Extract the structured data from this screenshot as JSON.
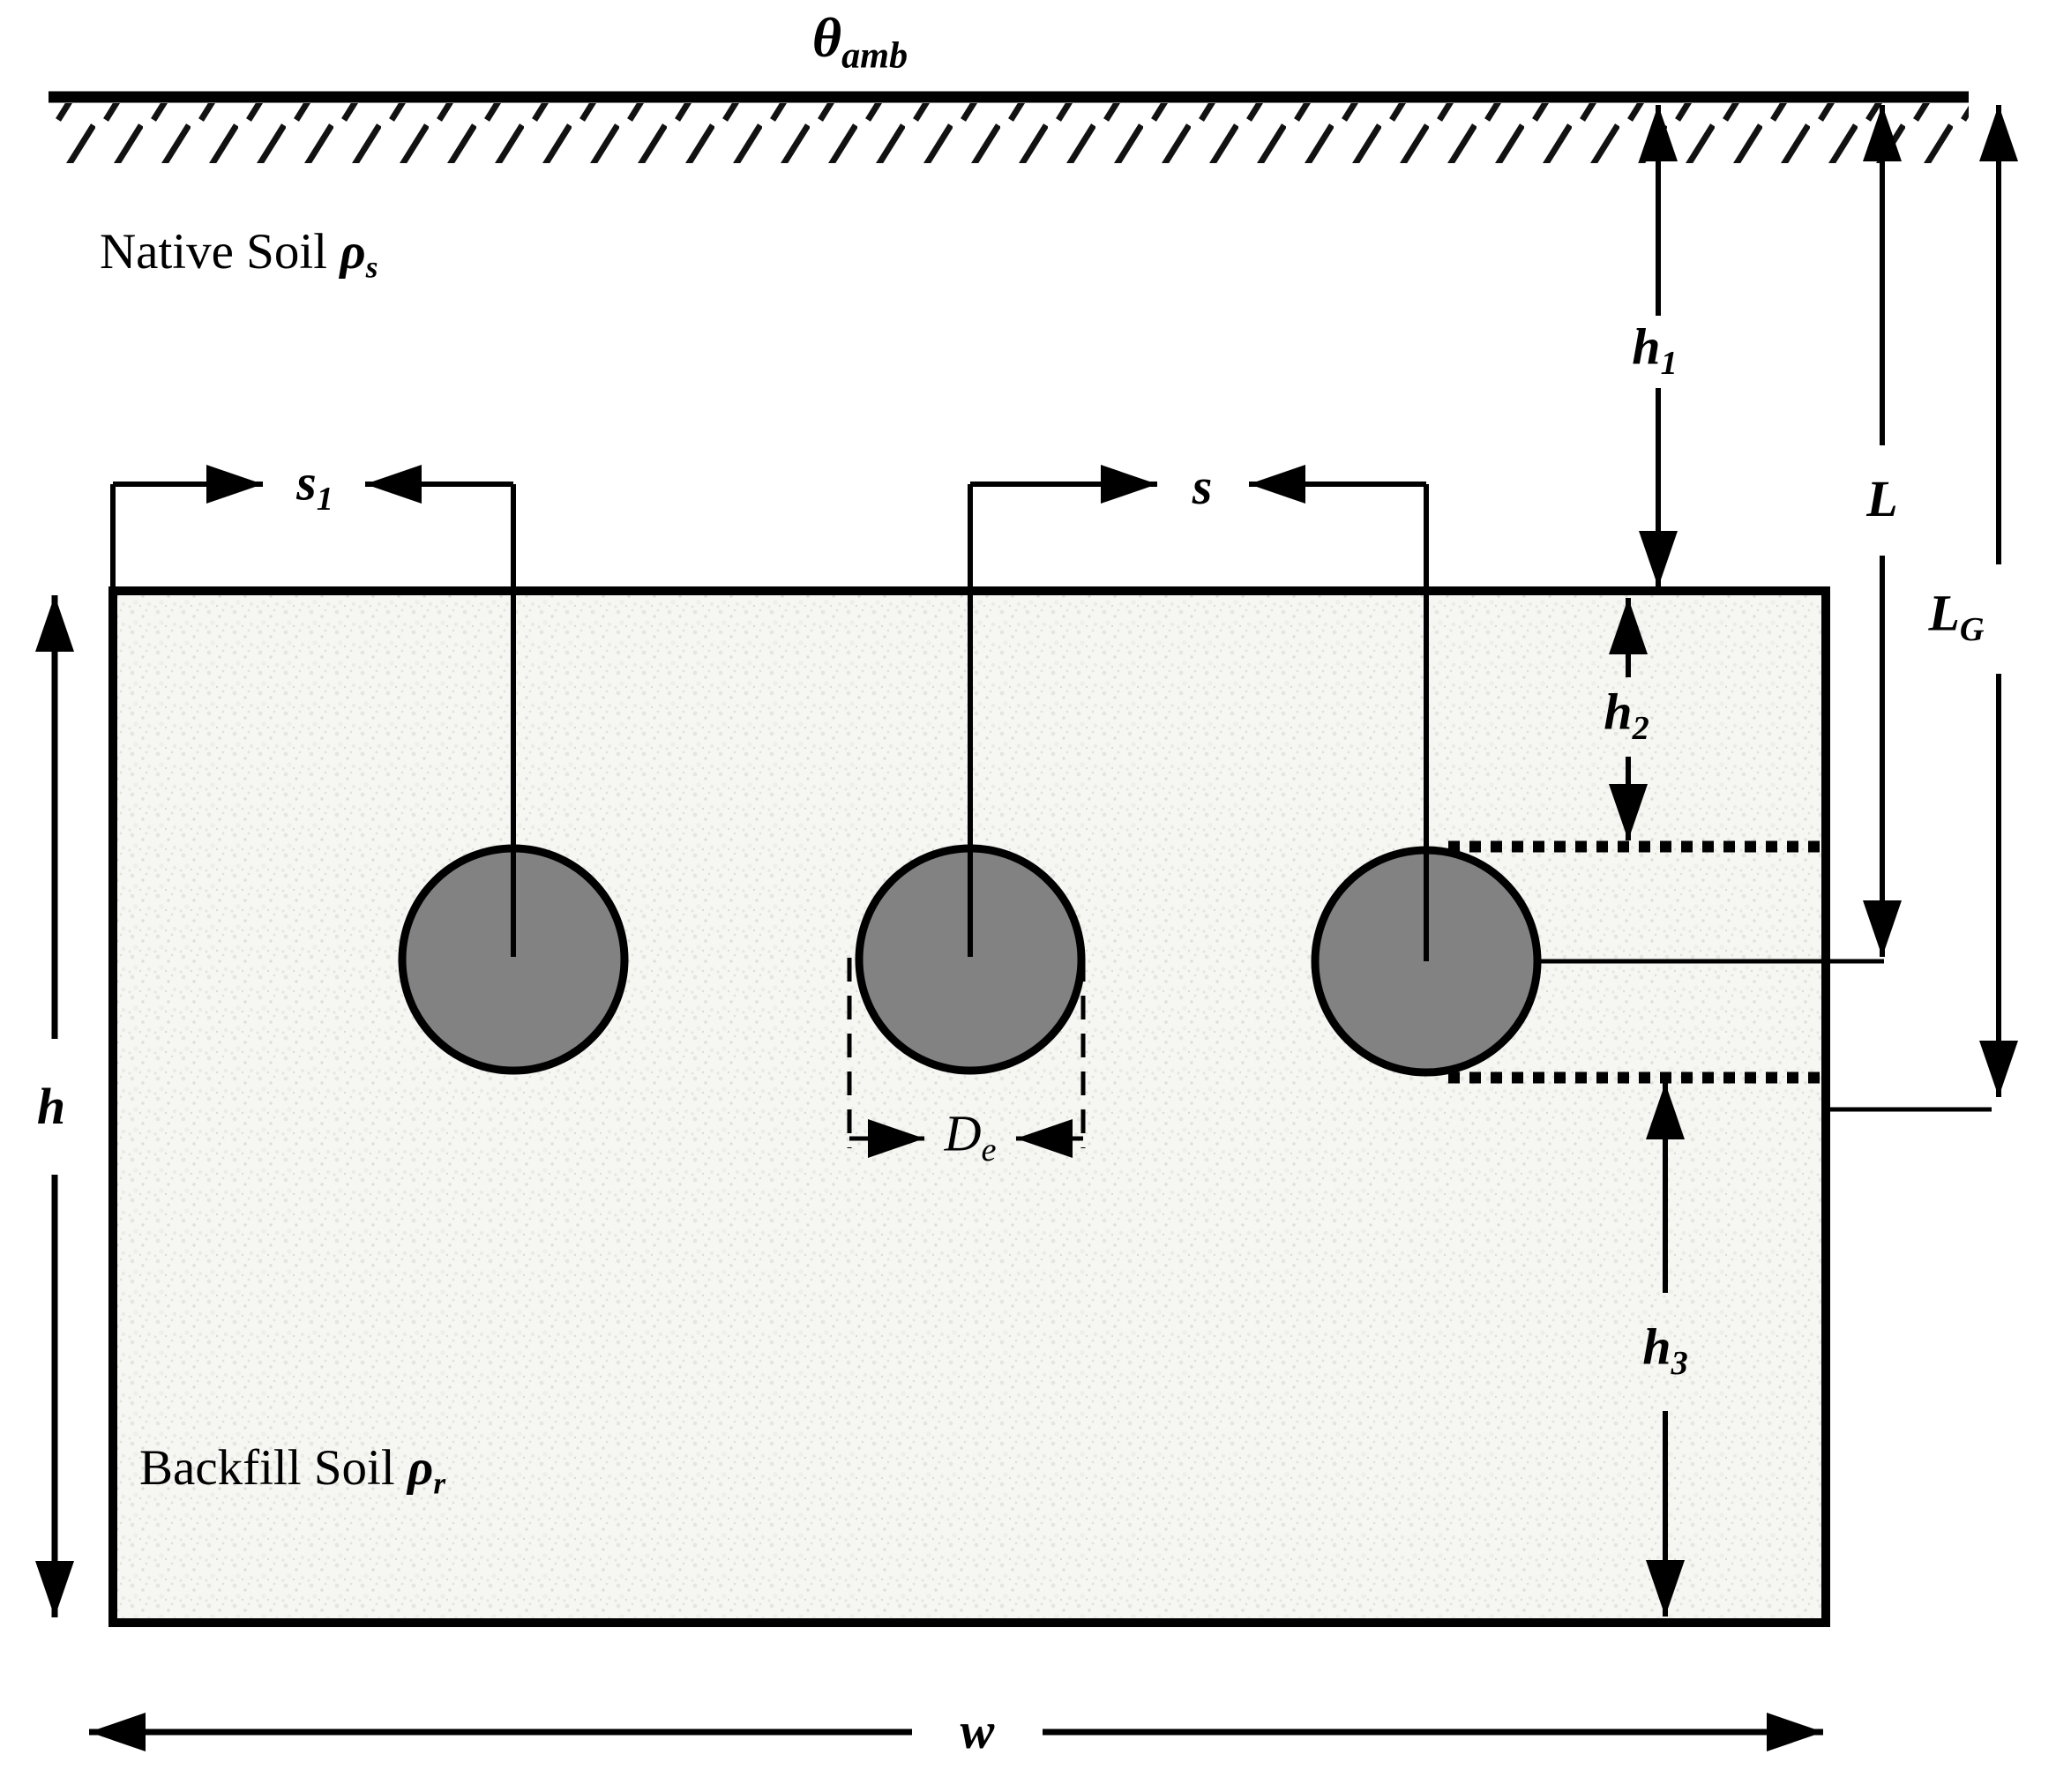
{
  "diagram_title": "Buried cable trench cross-section",
  "labels": {
    "theta_amb": {
      "main": "θ",
      "sub": "amb"
    },
    "native_soil": {
      "text": "Native Soil",
      "symbol": "ρ",
      "sub": "s"
    },
    "backfill_soil": {
      "text": "Backfill Soil",
      "symbol": "ρ",
      "sub": "r"
    },
    "s1": {
      "main": "s",
      "sub": "1"
    },
    "s": {
      "main": "s"
    },
    "h1": {
      "main": "h",
      "sub": "1"
    },
    "h2": {
      "main": "h",
      "sub": "2"
    },
    "h3": {
      "main": "h",
      "sub": "3"
    },
    "L": {
      "main": "L"
    },
    "LG": {
      "main": "L",
      "sub": "G"
    },
    "De": {
      "main": "D",
      "sub": "e"
    },
    "h": {
      "main": "h"
    },
    "w": {
      "main": "w"
    }
  },
  "colors": {
    "line": "#000000",
    "cable_fill": "#828282",
    "backfill_fill": "#f6f6f3",
    "hatch": "#111111"
  }
}
